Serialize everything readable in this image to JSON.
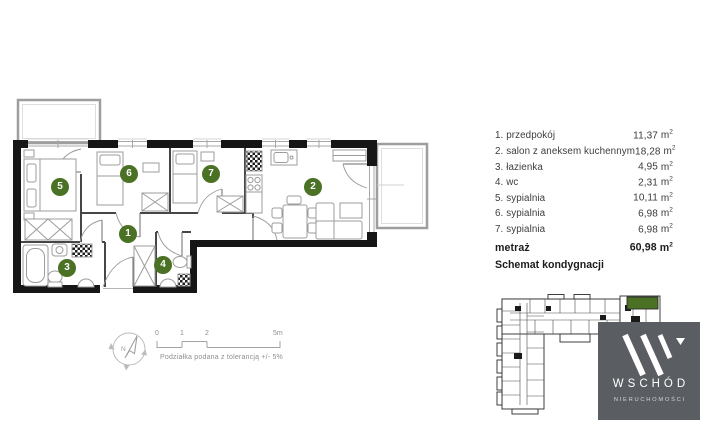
{
  "legend": {
    "items": [
      {
        "label": "1. przedpokój",
        "area": "11,37"
      },
      {
        "label": "2. salon z aneksem kuchennym",
        "area": "18,28"
      },
      {
        "label": "3. łazienka",
        "area": "4,95"
      },
      {
        "label": "4. wc",
        "area": "2,31"
      },
      {
        "label": "5. sypialnia",
        "area": "10,11"
      },
      {
        "label": "6. sypialnia",
        "area": "6,98"
      },
      {
        "label": "7. sypialnia",
        "area": "6,98"
      }
    ],
    "unit_base": "m",
    "unit_sup": "2",
    "total_label": "metraż",
    "total_area": "60,98",
    "schematic_heading": "Schemat kondygnacji"
  },
  "plan": {
    "numbers": [
      "1",
      "2",
      "3",
      "4",
      "5",
      "6",
      "7"
    ]
  },
  "scalebar": {
    "tick0": "0",
    "tick1": "1",
    "tick2": "2",
    "tick5": "5m",
    "note": "Podziałka podana z tolerancją +/- 5%"
  },
  "compass": {
    "north": "N"
  },
  "logo": {
    "name": "WSCHÓD",
    "subtitle": "NIERUCHOMOŚCI"
  },
  "colors": {
    "accent_green": "#4a7124",
    "logo_gray": "#5a5e62"
  }
}
